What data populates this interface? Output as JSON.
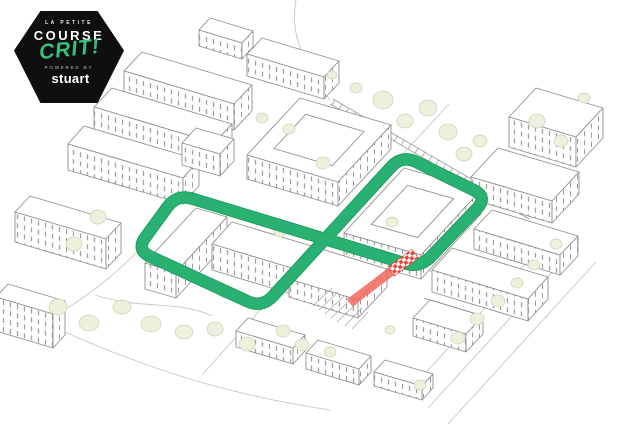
{
  "page": {
    "width": 624,
    "height": 441,
    "background": "#ffffff"
  },
  "badge": {
    "pretitle": "LA PETITE",
    "title_course": "COURSE",
    "title_crit": "CRIT!",
    "powered_by": "POWERED BY",
    "brand": "stuart",
    "icons": {
      "brand_icon": "stuart-cube-icon"
    },
    "colors": {
      "background": "#0f0f0f",
      "text": "#ffffff",
      "accent_green": "#35c17c",
      "muted": "#8d8d8d"
    }
  },
  "map": {
    "style": "hand-drawn isometric city line-art",
    "course": {
      "shape": "figure-eight loop around two city blocks",
      "color": "#29b172"
    },
    "finish": {
      "ramp_color": "#f2685e",
      "checker_red": "#e2453c",
      "checker_white": "#ffffff"
    },
    "palette": {
      "line_art": "#8f8f8f",
      "street": "#c6c6c6",
      "tree_fill": "#eef0dc",
      "tree_outline": "#cdd1b8"
    }
  }
}
